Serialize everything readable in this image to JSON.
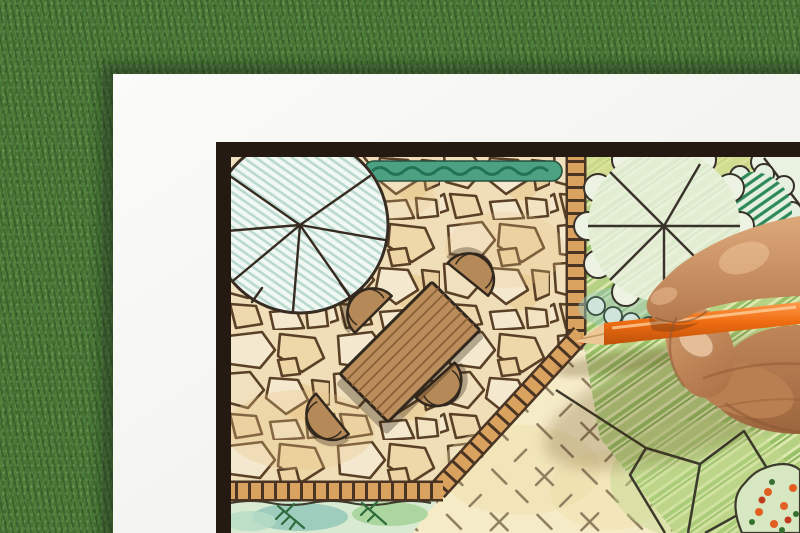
{
  "scene": {
    "description": "Overhead photo of a hand drawing a backyard garden landscape design plan with an orange colored pencil on white paper laid over green grass",
    "surface": "artificial green grass",
    "paper": "white sheet with dark plan border",
    "plan_elements": [
      "flagstone patio with irregular stones",
      "large round tree canopy symbol with radial spokes",
      "clipped hedge strip",
      "rectangular wooden garden table",
      "four rounded patio chairs",
      "brick edge path borders",
      "lawn with scalloped tree canopies",
      "dark hatched shrub",
      "gravel area with cross hatch marks",
      "planting bed with conifer sprigs",
      "flower bed with orange blooms",
      "boulder and path outlines"
    ],
    "drawing_tool": "orange colored pencil",
    "hand": "right hand holding pencil, entering from right edge",
    "colors": {
      "grass": "#477536",
      "paper": "#f5f6f3",
      "plan_frame": "#241a11",
      "stone": "#f3e7c6",
      "stone_joint": "#51402c",
      "brick": "#d9a25f",
      "hedge": "#4da183",
      "lawn": "#c9dd9a",
      "tree_hatch": "#b9d9cf",
      "furniture": "#b68a58",
      "gravel": "#f5ebc8",
      "pencil": "#f06d12",
      "skin": "#c9906a"
    }
  }
}
